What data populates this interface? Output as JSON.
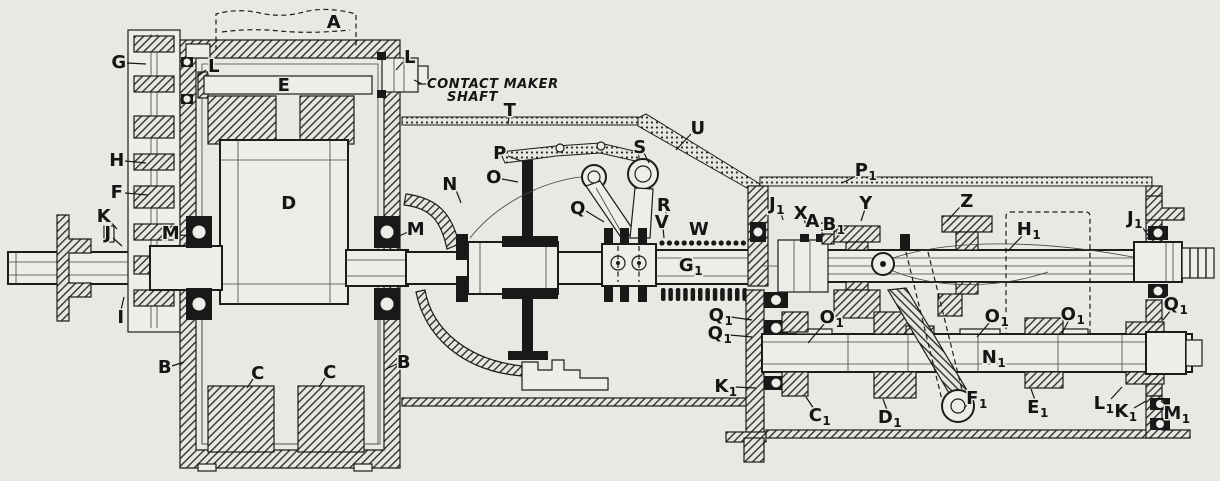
{
  "figure": {
    "paper_color": "#e9e8e3",
    "ink_color": "#1c1c1c",
    "type": "technical-cross-section"
  },
  "annotation": {
    "line1": "CONTACT MAKER",
    "line2": "SHAFT"
  },
  "labels": [
    {
      "t": "A",
      "x": 334,
      "y": 22
    },
    {
      "t": "G",
      "x": 119,
      "y": 62,
      "leader": [
        127,
        63,
        146,
        64
      ]
    },
    {
      "t": "L",
      "x": 214,
      "y": 66,
      "leader": [
        206,
        70,
        197,
        77
      ]
    },
    {
      "t": "E",
      "x": 284,
      "y": 85
    },
    {
      "t": "L",
      "x": 410,
      "y": 57,
      "leader": [
        403,
        62,
        396,
        70
      ]
    },
    {
      "t": "H",
      "x": 117,
      "y": 160,
      "leader": [
        125,
        161,
        146,
        163
      ]
    },
    {
      "t": "F",
      "x": 117,
      "y": 192,
      "leader": [
        125,
        193,
        148,
        195
      ]
    },
    {
      "t": "K",
      "x": 104,
      "y": 216,
      "leader": [
        110,
        221,
        117,
        229
      ]
    },
    {
      "t": "J",
      "x": 108,
      "y": 233,
      "leader": [
        113,
        238,
        122,
        246
      ]
    },
    {
      "t": "M",
      "x": 171,
      "y": 233,
      "leader": [
        180,
        235,
        193,
        236
      ]
    },
    {
      "t": "I",
      "x": 121,
      "y": 317,
      "leader": [
        121,
        310,
        124,
        297
      ]
    },
    {
      "t": "B",
      "x": 165,
      "y": 367,
      "leader": [
        172,
        366,
        184,
        362
      ]
    },
    {
      "t": "C",
      "x": 258,
      "y": 373,
      "leader": [
        253,
        379,
        247,
        388
      ]
    },
    {
      "t": "C",
      "x": 330,
      "y": 372,
      "leader": [
        325,
        378,
        319,
        387
      ]
    },
    {
      "t": "B",
      "x": 404,
      "y": 362,
      "leader": [
        397,
        364,
        386,
        369
      ]
    },
    {
      "t": "D",
      "x": 289,
      "y": 203
    },
    {
      "t": "T",
      "x": 510,
      "y": 110,
      "leader": [
        509,
        116,
        508,
        124
      ]
    },
    {
      "t": "U",
      "x": 698,
      "y": 128,
      "leader": [
        691,
        134,
        676,
        150
      ]
    },
    {
      "t": "P",
      "x": 500,
      "y": 153,
      "leader": [
        508,
        156,
        524,
        162
      ]
    },
    {
      "t": "O",
      "x": 494,
      "y": 177,
      "leader": [
        502,
        179,
        518,
        182
      ]
    },
    {
      "t": "N",
      "x": 450,
      "y": 184,
      "leader": [
        456,
        190,
        461,
        203
      ]
    },
    {
      "t": "Q",
      "x": 578,
      "y": 208,
      "leader": [
        586,
        211,
        604,
        222
      ]
    },
    {
      "t": "S",
      "x": 640,
      "y": 147,
      "leader": [
        644,
        153,
        649,
        163
      ]
    },
    {
      "t": "R",
      "x": 664,
      "y": 205,
      "leader": [
        666,
        211,
        667,
        222
      ]
    },
    {
      "t": "V",
      "x": 662,
      "y": 222,
      "leader": [
        663,
        228,
        664,
        238
      ]
    },
    {
      "t": "W",
      "x": 699,
      "y": 229
    },
    {
      "t": "M",
      "x": 416,
      "y": 229,
      "leader": [
        408,
        232,
        397,
        237
      ]
    },
    {
      "t": "G",
      "s": "1",
      "x": 691,
      "y": 265
    },
    {
      "t": "Q",
      "s": "1",
      "x": 721,
      "y": 315,
      "leader": [
        731,
        317,
        752,
        320
      ]
    },
    {
      "t": "Q",
      "s": "1",
      "x": 720,
      "y": 333,
      "leader": [
        730,
        335,
        752,
        337
      ]
    },
    {
      "t": "K",
      "s": "1",
      "x": 726,
      "y": 386,
      "leader": [
        735,
        387,
        756,
        388
      ]
    },
    {
      "t": "P",
      "s": "1",
      "x": 866,
      "y": 170,
      "leader": [
        858,
        175,
        842,
        183
      ]
    },
    {
      "t": "J",
      "s": "1",
      "x": 777,
      "y": 204,
      "leader": [
        780,
        210,
        783,
        220
      ]
    },
    {
      "t": "X",
      "x": 801,
      "y": 213,
      "leader": [
        804,
        219,
        807,
        228
      ]
    },
    {
      "t": "A",
      "s": "1",
      "x": 817,
      "y": 221,
      "leader": [
        820,
        227,
        823,
        235
      ]
    },
    {
      "t": "B",
      "s": "1",
      "x": 834,
      "y": 224,
      "leader": [
        836,
        230,
        838,
        237
      ]
    },
    {
      "t": "Y",
      "x": 866,
      "y": 203,
      "leader": [
        865,
        209,
        861,
        221
      ]
    },
    {
      "t": "Z",
      "x": 967,
      "y": 201,
      "leader": [
        960,
        207,
        947,
        221
      ]
    },
    {
      "t": "H",
      "s": "1",
      "x": 1029,
      "y": 229,
      "leader": [
        1023,
        235,
        1008,
        251
      ]
    },
    {
      "t": "J",
      "s": "1",
      "x": 1135,
      "y": 218,
      "leader": [
        1140,
        224,
        1150,
        238
      ]
    },
    {
      "t": "Q",
      "s": "1",
      "x": 1176,
      "y": 304,
      "leader": [
        1171,
        310,
        1163,
        320
      ]
    },
    {
      "t": "O",
      "s": "1",
      "x": 832,
      "y": 317,
      "leader": [
        825,
        323,
        808,
        343
      ]
    },
    {
      "t": "O",
      "s": "1",
      "x": 997,
      "y": 316,
      "leader": [
        990,
        322,
        977,
        337
      ]
    },
    {
      "t": "O",
      "s": "1",
      "x": 1073,
      "y": 314,
      "leader": [
        1069,
        320,
        1062,
        333
      ]
    },
    {
      "t": "N",
      "s": "1",
      "x": 994,
      "y": 357
    },
    {
      "t": "F",
      "s": "1",
      "x": 977,
      "y": 398,
      "leader": [
        969,
        403,
        964,
        408
      ]
    },
    {
      "t": "E",
      "s": "1",
      "x": 1038,
      "y": 407,
      "leader": [
        1035,
        400,
        1031,
        389
      ]
    },
    {
      "t": "L",
      "s": "1",
      "x": 1104,
      "y": 403,
      "leader": [
        1111,
        399,
        1122,
        387
      ]
    },
    {
      "t": "K",
      "s": "1",
      "x": 1126,
      "y": 411,
      "leader": [
        1134,
        408,
        1146,
        401
      ]
    },
    {
      "t": "M",
      "s": "1",
      "x": 1177,
      "y": 413,
      "leader": [
        1170,
        408,
        1161,
        401
      ]
    },
    {
      "t": "C",
      "s": "1",
      "x": 820,
      "y": 415,
      "leader": [
        814,
        409,
        806,
        397
      ]
    },
    {
      "t": "D",
      "s": "1",
      "x": 890,
      "y": 417,
      "leader": [
        887,
        410,
        883,
        399
      ]
    }
  ]
}
